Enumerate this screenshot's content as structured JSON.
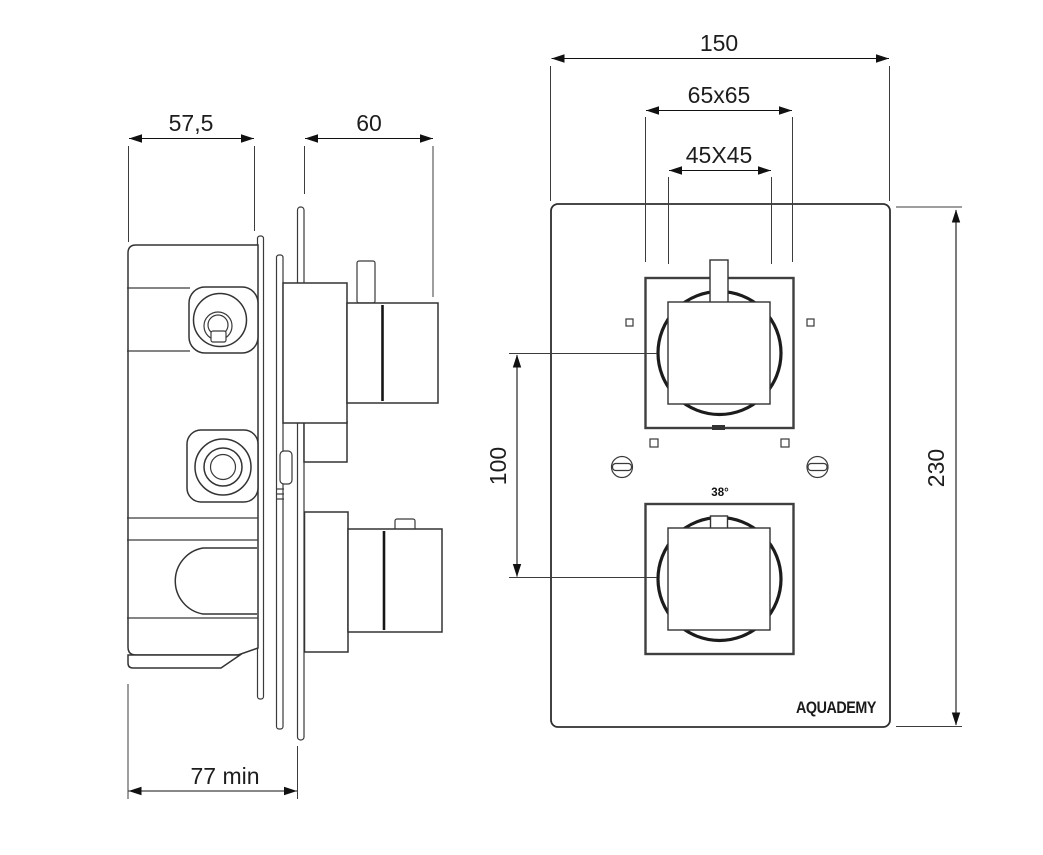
{
  "drawing": {
    "title": "thermostatic-shower-valve-technical-drawing",
    "side_view": {
      "dim_rough_depth": "57,5",
      "dim_trim_depth": "60",
      "dim_min_recess": "77 min"
    },
    "front_view": {
      "dim_width": "150",
      "dim_plate_square": "65x65",
      "dim_handle_square": "45X45",
      "dim_handle_spacing": "100",
      "dim_height": "230",
      "temp_marker": "38°",
      "brand": "AQUADEMY"
    },
    "colors": {
      "line": "#333333",
      "dimension": "#111111",
      "background": "#ffffff"
    }
  }
}
